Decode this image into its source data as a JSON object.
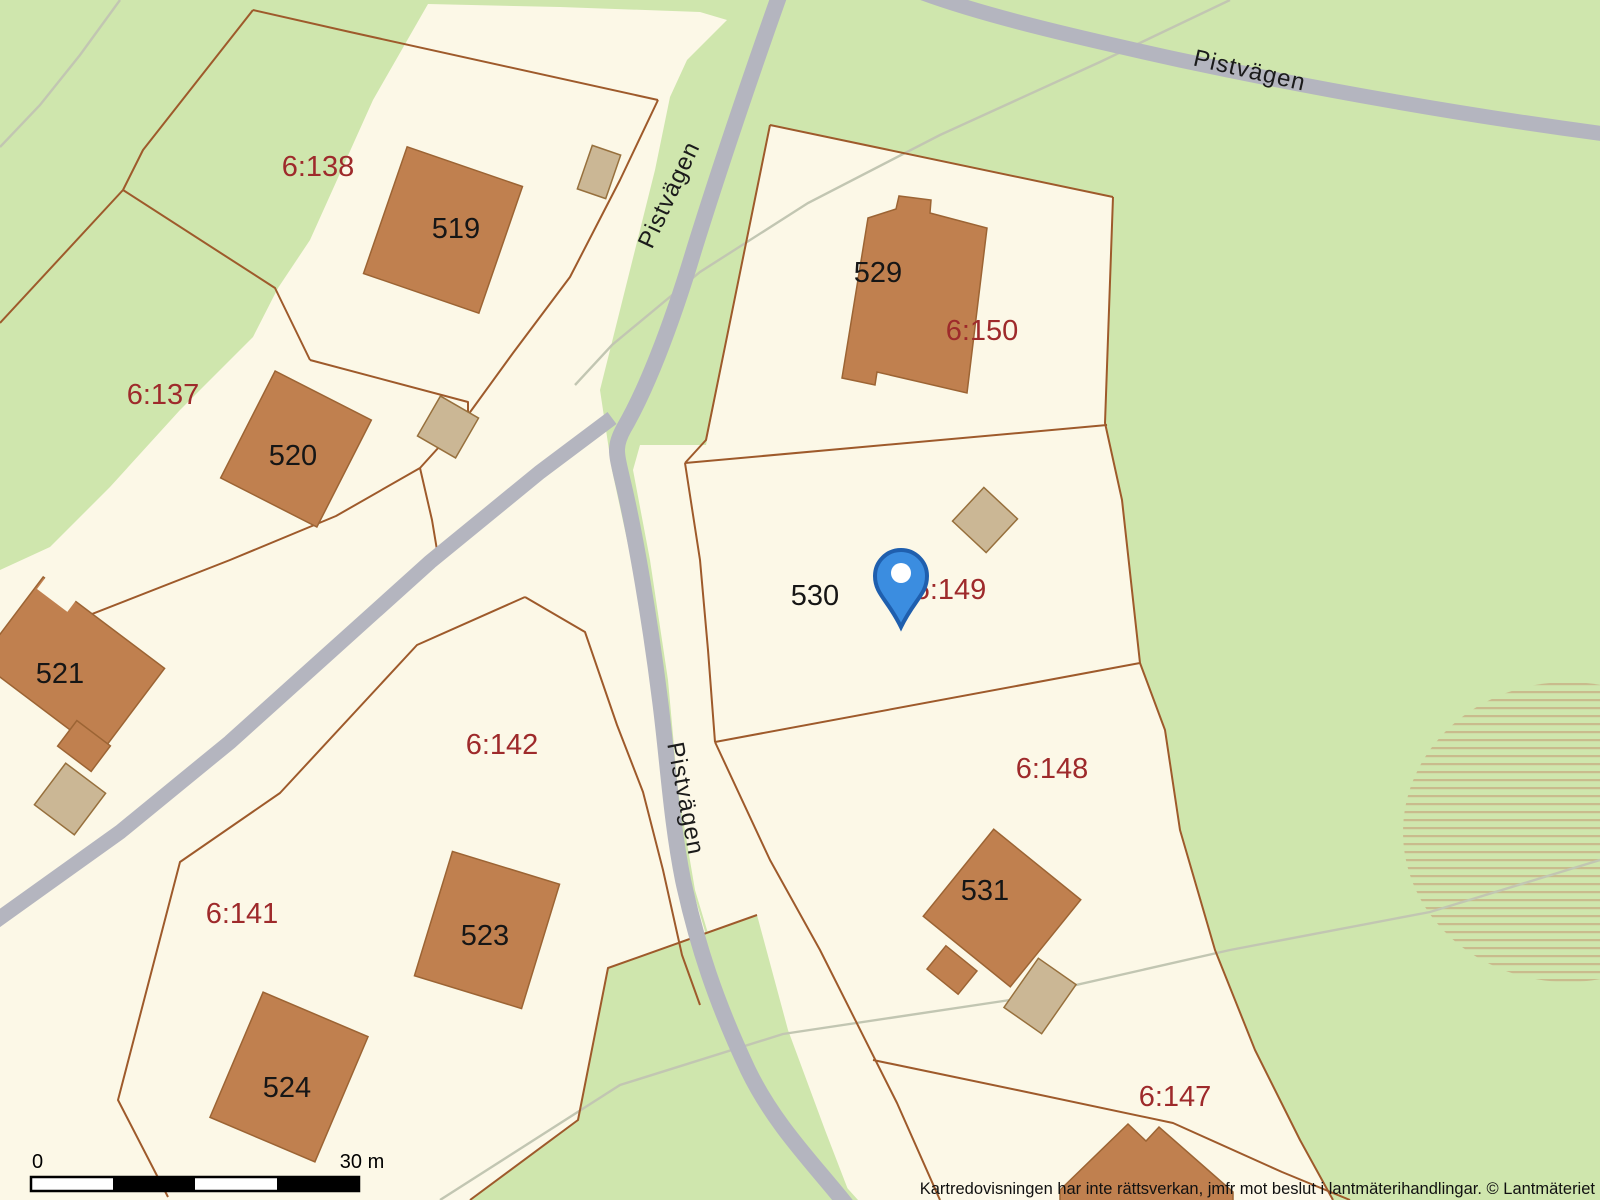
{
  "map": {
    "road_labels": [
      {
        "text": "Pistvägen"
      },
      {
        "text": "Pistvägen"
      },
      {
        "text": "Pistvägen"
      }
    ],
    "house_numbers": [
      {
        "text": "519"
      },
      {
        "text": "520"
      },
      {
        "text": "521"
      },
      {
        "text": "523"
      },
      {
        "text": "524"
      },
      {
        "text": "529"
      },
      {
        "text": "530"
      },
      {
        "text": "531"
      }
    ],
    "parcel_ids": [
      {
        "text": "6:138"
      },
      {
        "text": "6:137"
      },
      {
        "text": "6:141"
      },
      {
        "text": "6:142"
      },
      {
        "text": "6:150"
      },
      {
        "text": "6:149"
      },
      {
        "text": "6:148"
      },
      {
        "text": "6:147"
      }
    ],
    "marker": {
      "name": "selected-location"
    },
    "scale_bar": {
      "start_label": "0",
      "end_label": "30 m"
    },
    "attribution": "Kartredovisningen har inte rättsverkan, jmfr mot beslut i lantmäterihandlingar. © Lantmäteriet",
    "colors": {
      "vegetation": "#cfe6ad",
      "parcel_fill": "#fcf8e7",
      "road": "#b4b5bf",
      "building": "#c0804f",
      "outbuilding": "#cbb795",
      "boundary_line": "#9e5a2b",
      "parcel_label": "#9e2a2b",
      "path_line": "#c2c6b2",
      "marker_blue": "#3b8de0"
    }
  }
}
